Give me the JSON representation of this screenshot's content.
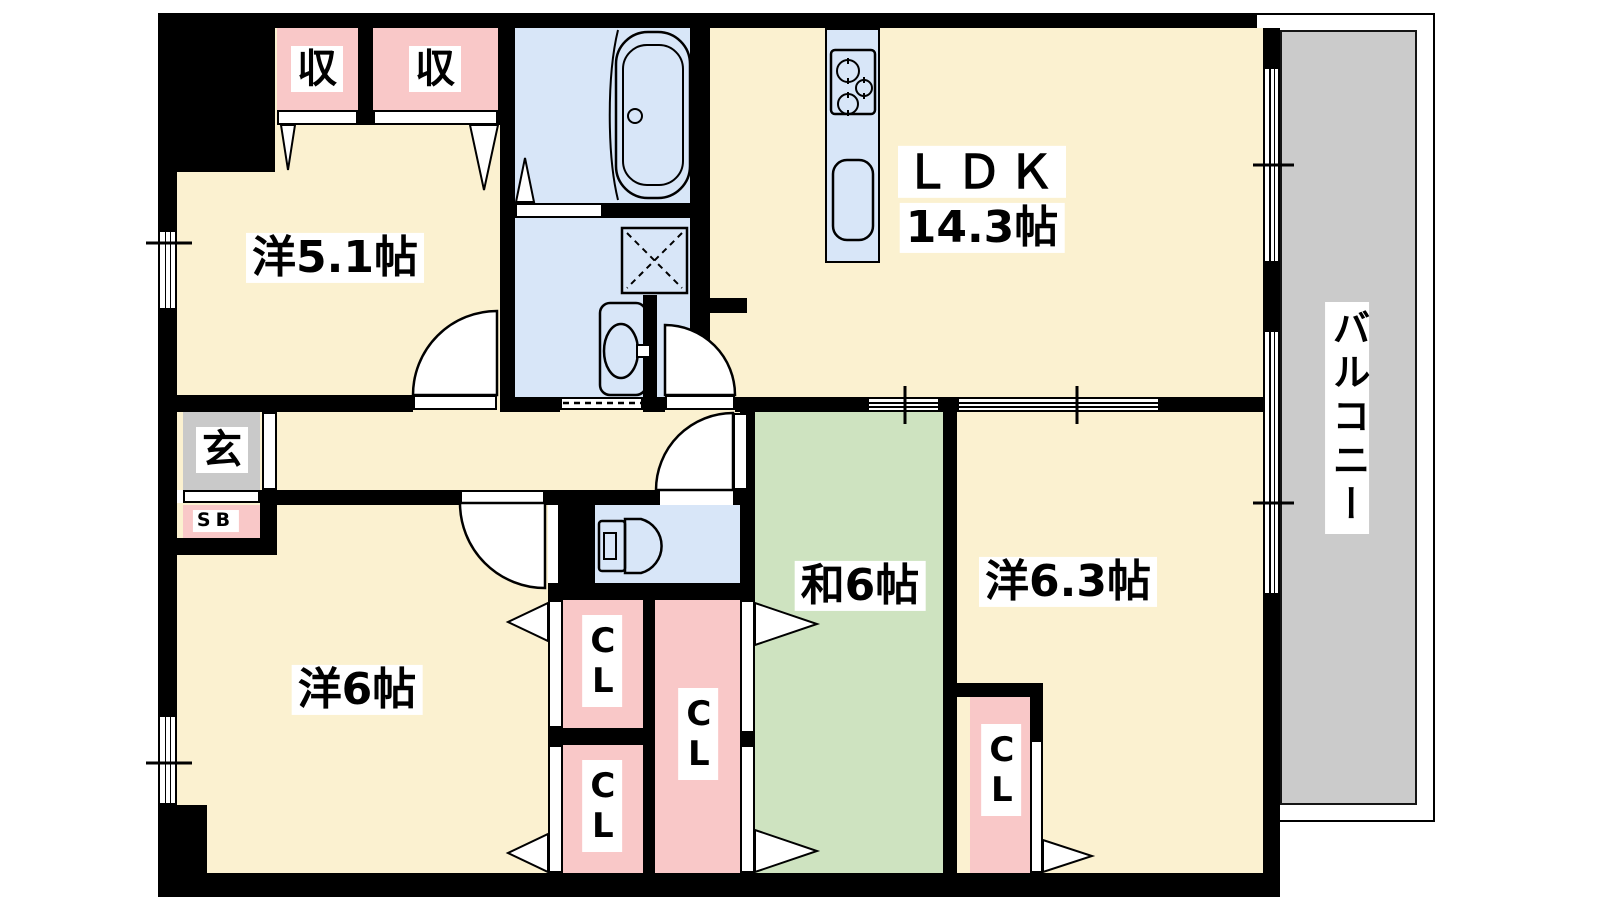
{
  "rooms": {
    "western_5_1": {
      "label": "洋5.1帖"
    },
    "ldk": {
      "label": "ＬＤＫ",
      "size": "14.3帖"
    },
    "western_6": {
      "label": "洋6帖"
    },
    "japanese_6": {
      "label": "和6帖"
    },
    "western_6_3": {
      "label": "洋6.3帖"
    },
    "balcony": {
      "label": "バルコニー"
    },
    "entrance": {
      "label": "玄"
    }
  },
  "storage": {
    "oshiire_left": "収",
    "oshiire_right": "収",
    "closet_west_top": "CL",
    "closet_west_bottom": "CL",
    "closet_center": "CL",
    "closet_east": "CL",
    "shoe_box": "SB"
  },
  "colors": {
    "wall": "#000000",
    "floor_wood": "#FBF1D0",
    "tatami": "#CEE3C0",
    "wet_area": "#D8E6F8",
    "closet": "#F9C8C8",
    "balcony_deck": "#CBCBCB",
    "entrance_floor": "#C9C9C9"
  }
}
